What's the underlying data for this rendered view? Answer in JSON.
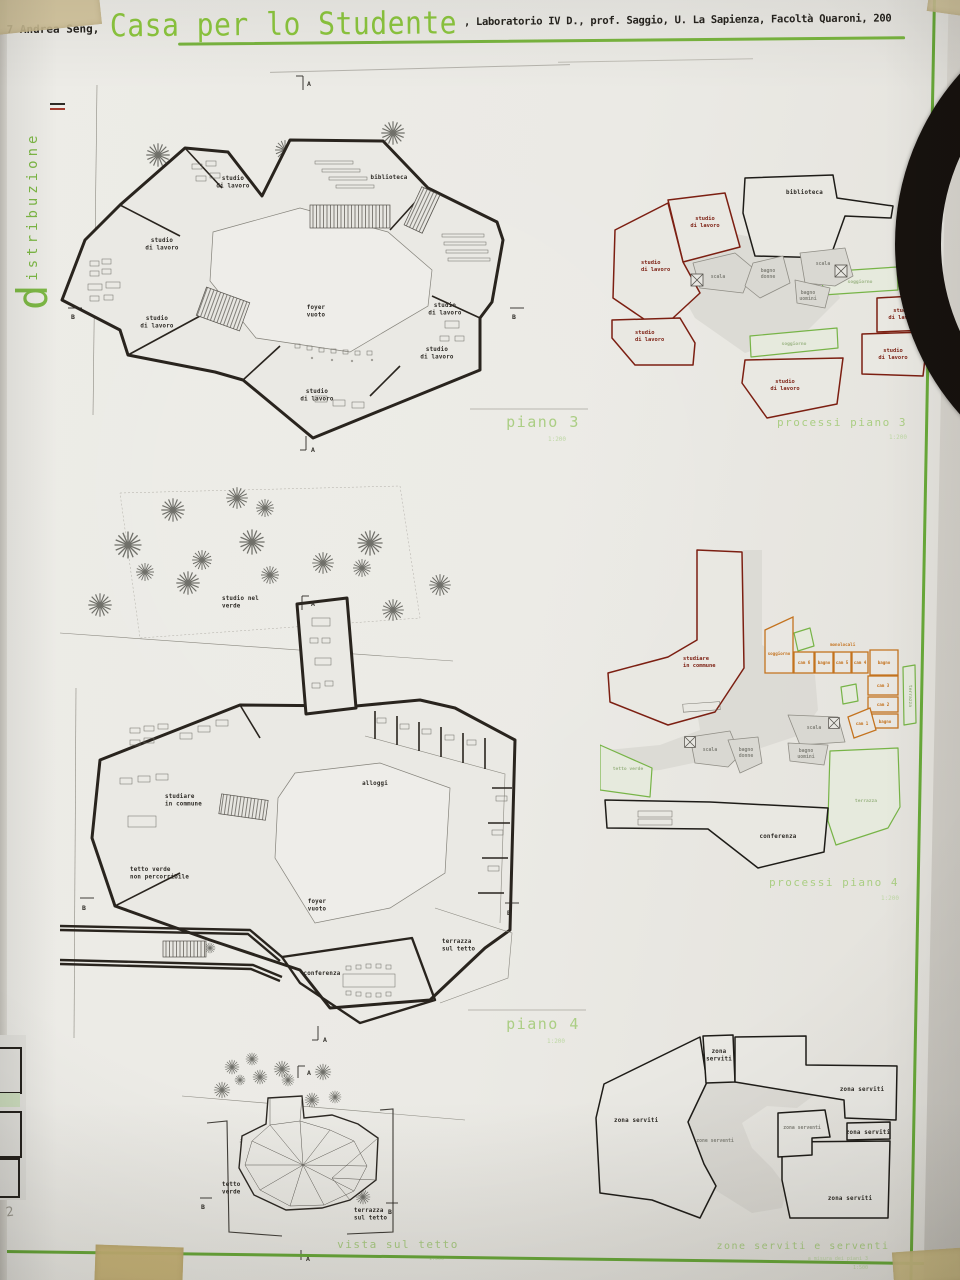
{
  "colors": {
    "accent_green": "#79b53f",
    "label_green": "#abce84",
    "dark_red": "#7c1f12",
    "orange": "#c4731f",
    "tape": "#cfbf93",
    "paper": "#ebeae5"
  },
  "header": {
    "author": "07 Andrea Seng,",
    "title": "Casa per lo Studente",
    "course": ", Laboratorio IV D., prof. Saggio, U. La Sapienza, Facoltà Quaroni, 200"
  },
  "sidebar": {
    "initial": "d",
    "rest": "istribuzione"
  },
  "markers": {
    "a": "A",
    "b": "B"
  },
  "piano3": {
    "caption": "piano 3",
    "scale": "1:200",
    "studio": "studio\ndi lavoro",
    "biblioteca": "biblioteca",
    "foyer": "foyer\nvuoto"
  },
  "processi3": {
    "caption": "processi piano 3",
    "scale": "1:200",
    "studio": "studio\ndi lavoro",
    "biblioteca": "biblioteca",
    "scala": "scala",
    "bagno_donne": "bagno\ndonne",
    "bagno_uomini": "bagno\nuomini",
    "soggiorno": "soggiorno"
  },
  "piano4": {
    "caption": "piano 4",
    "scale": "1:200",
    "studio_nel_verde": "studio nel\nverde",
    "studiare": "studiare\nin commune",
    "alloggi": "alloggi",
    "tetto_verde": "tetto verde\nnon percorribile",
    "foyer": "foyer\nvuoto",
    "conferenza": "conferenza",
    "terrazza": "terrazza\nsul tetto"
  },
  "processi4": {
    "caption": "processi piano 4",
    "scale": "1:200",
    "studiare": "studiare\nin commune",
    "monolocali": "monolocali",
    "soggiorno": "soggiorno",
    "cam6": "cam 6",
    "cam5": "cam 5",
    "cam4": "cam 4",
    "cam3": "cam 3",
    "cam2": "cam 2",
    "cam1": "cam 1",
    "bagno": "bagno",
    "terrazza": "terrazza",
    "tetto_verde": "tetto verde",
    "scala": "scala",
    "bagno_donne": "bagno\ndonne",
    "bagno_uomini": "bagno\nuomini",
    "conferenza": "conferenza"
  },
  "vista": {
    "caption": "vista sul tetto",
    "scale": "1:500",
    "tetto_verde": "tetto\nverde",
    "terrazza": "terrazza\nsul tetto"
  },
  "zone": {
    "caption": "zone serviti e serventi",
    "subtitle": "a misura dei piani 3",
    "subscale": "1:500",
    "zona_serviti": "zona serviti",
    "zona_serviti_2l": "zona\nserviti",
    "zona_serventi": "zona serventi",
    "zone_serventi": "zone serventi"
  },
  "margin_note": "2"
}
